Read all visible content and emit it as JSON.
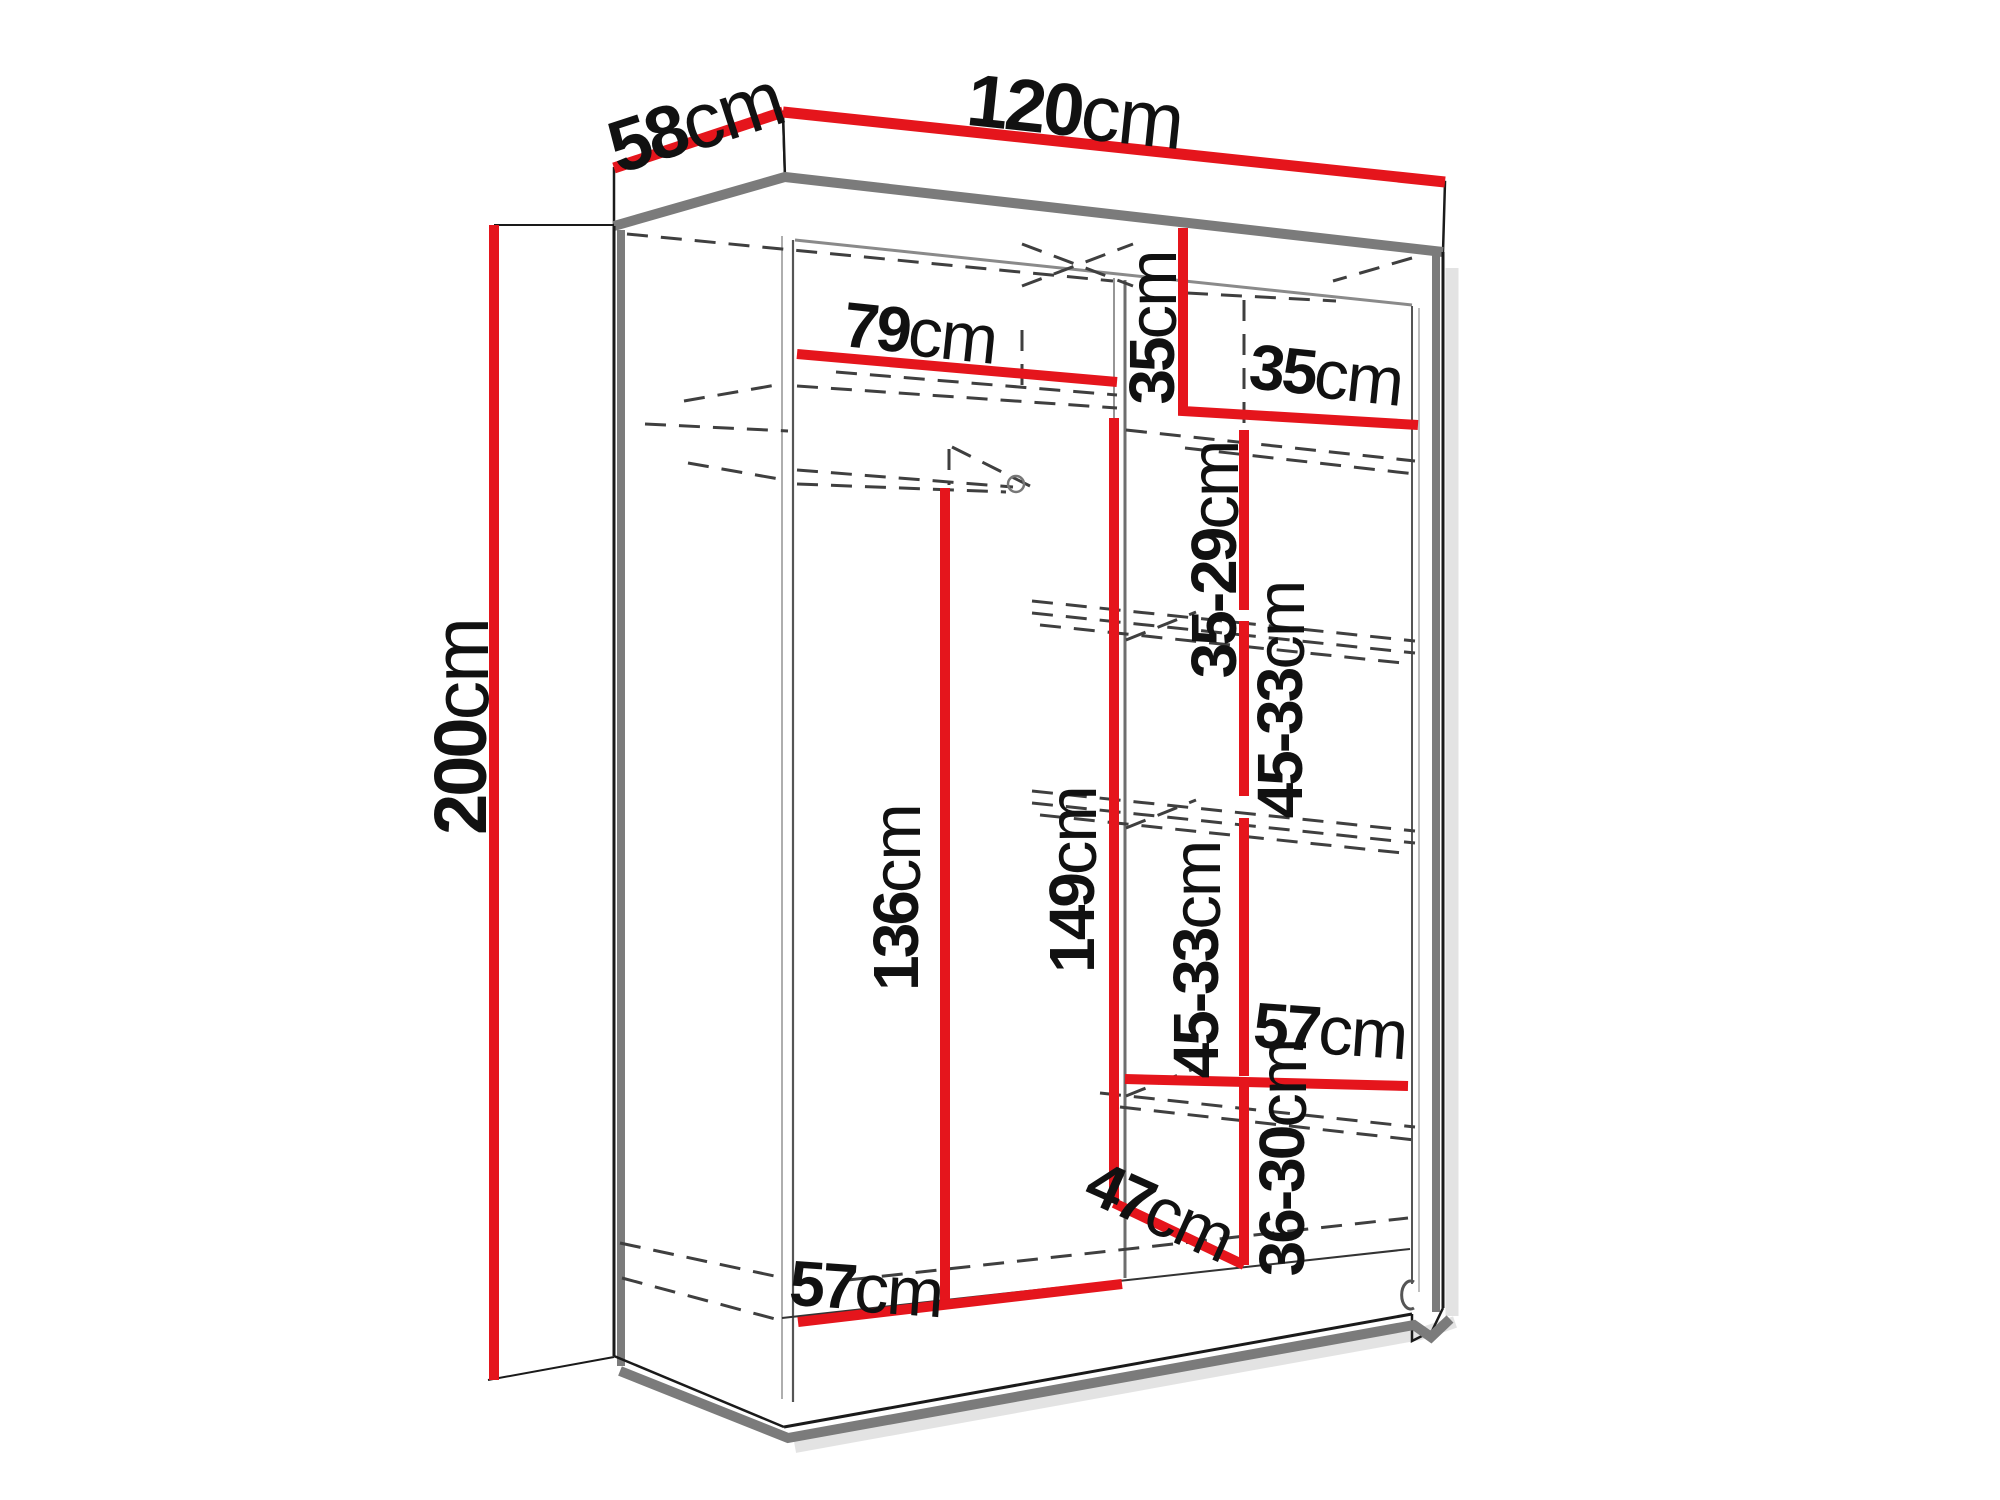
{
  "diagram": {
    "kind": "wardrobe-dimension-drawing",
    "unit": "cm"
  },
  "labels": {
    "depth": {
      "value": "58",
      "unit": "cm"
    },
    "width": {
      "value": "120",
      "unit": "cm"
    },
    "height": {
      "value": "200",
      "unit": "cm"
    },
    "left_section_width": {
      "value": "79",
      "unit": "cm"
    },
    "top_shelf_height": {
      "value": "35",
      "unit": "cm"
    },
    "right_section_width": {
      "value": "35",
      "unit": "cm"
    },
    "shelf_spacing_1": {
      "value": "35-29",
      "unit": "cm"
    },
    "shelf_spacing_2": {
      "value": "45-33",
      "unit": "cm"
    },
    "hanging_space_height": {
      "value": "136",
      "unit": "cm"
    },
    "middle_height": {
      "value": "149",
      "unit": "cm"
    },
    "shelf_spacing_3": {
      "value": "45-33",
      "unit": "cm"
    },
    "lower_shelf_depth": {
      "value": "57",
      "unit": "cm"
    },
    "lower_spacing": {
      "value": "36-30",
      "unit": "cm"
    },
    "bottom_compartment_depth": {
      "value": "47",
      "unit": "cm"
    },
    "floor_depth": {
      "value": "57",
      "unit": "cm"
    }
  },
  "colors": {
    "dimension-line": "#e5151c",
    "structure-gray": "#7b7b7b",
    "outline": "#1a1a1a",
    "dashed": "#3f3f3f",
    "background": "#ffffff"
  }
}
